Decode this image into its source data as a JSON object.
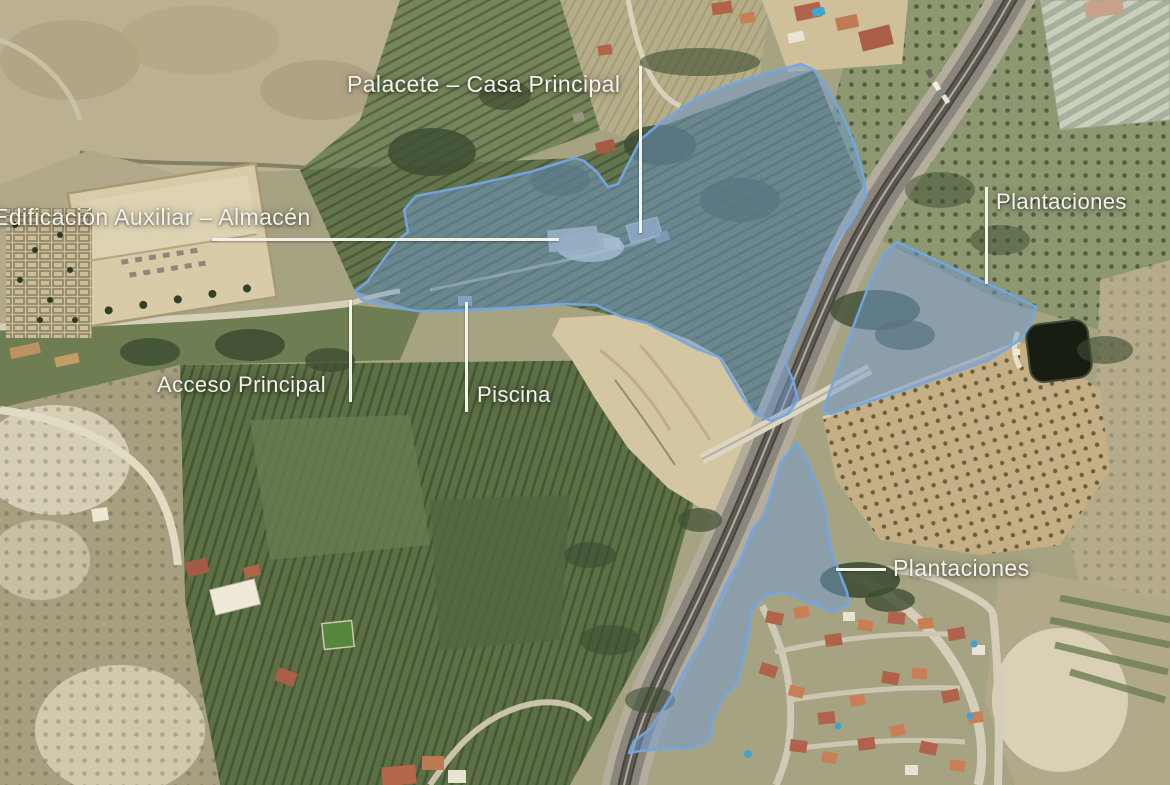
{
  "annotations": {
    "palacete": {
      "text": "Palacete – Casa Principal"
    },
    "almacen": {
      "text": "Edificación Auxiliar – Almacén"
    },
    "acceso": {
      "text": "Acceso Principal"
    },
    "piscina": {
      "text": "Piscina"
    },
    "plantaciones_north": {
      "text": "Plantaciones"
    },
    "plantaciones_south": {
      "text": "Plantaciones"
    }
  },
  "colors": {
    "highlight_fill": "rgba(112,153,208,0.5)",
    "highlight_stroke": "#73a7e3",
    "label_text": "#f4f2ec",
    "leader_line": "#f4f2ec"
  }
}
